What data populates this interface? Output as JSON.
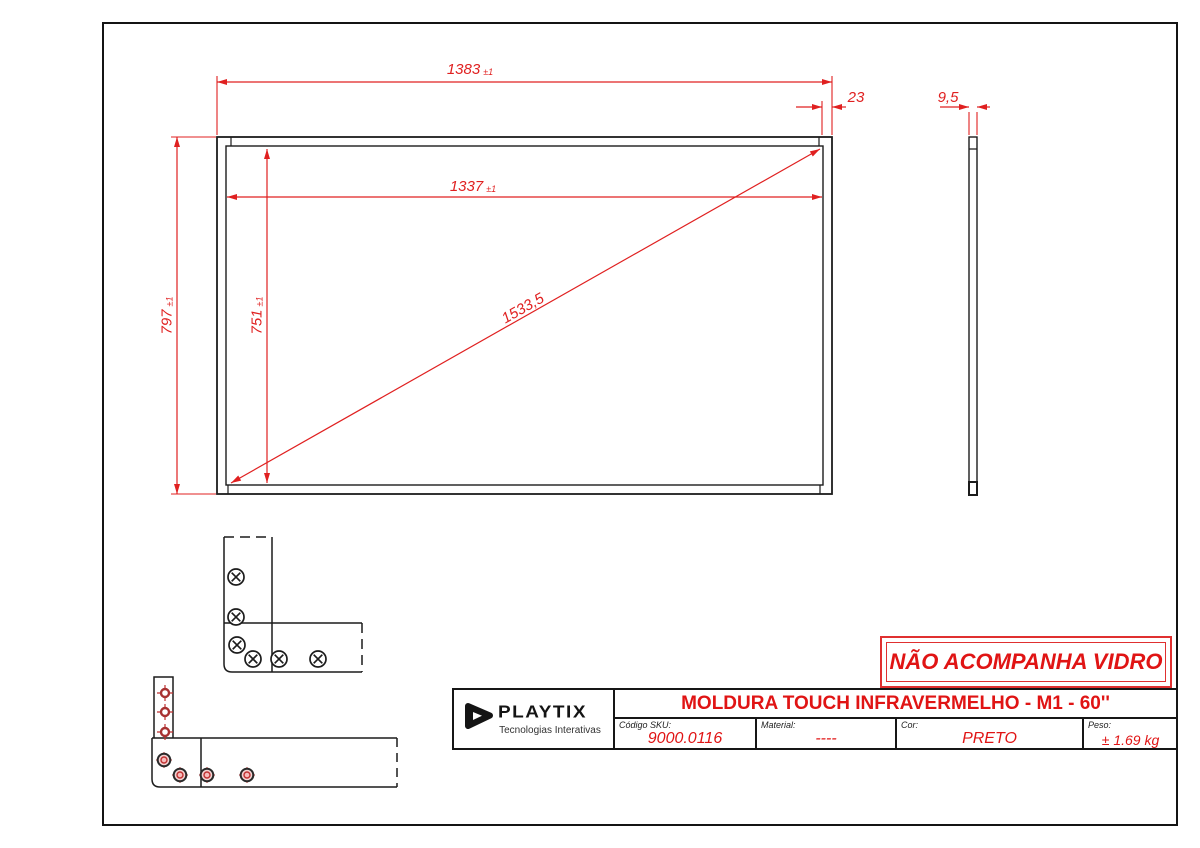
{
  "drawing": {
    "dims": {
      "outer_width": {
        "value": "1383",
        "tol": "±1"
      },
      "inner_width": {
        "value": "1337",
        "tol": "±1"
      },
      "outer_height": {
        "value": "797",
        "tol": "±1"
      },
      "inner_height": {
        "value": "751",
        "tol": "±1"
      },
      "diagonal": {
        "value": "1533,5"
      },
      "border_width": {
        "value": "23"
      },
      "thickness": {
        "value": "9,5"
      }
    },
    "notice": "NÃO ACOMPANHA VIDRO",
    "title_block": {
      "logo": {
        "brand": "PLAYTIX",
        "tagline": "Tecnologias Interativas"
      },
      "title": "MOLDURA TOUCH INFRAVERMELHO - M1 - 60''",
      "fields": [
        {
          "label": "Código SKU:",
          "value": "9000.0116"
        },
        {
          "label": "Material:",
          "value": "----"
        },
        {
          "label": "Cor:",
          "value": "PRETO"
        },
        {
          "label": "Peso:",
          "value": "± 1.69 kg"
        }
      ]
    },
    "colors": {
      "accent_red": "#e01414",
      "dim_red": "#e02020",
      "line_black": "#1c1c1c"
    }
  }
}
